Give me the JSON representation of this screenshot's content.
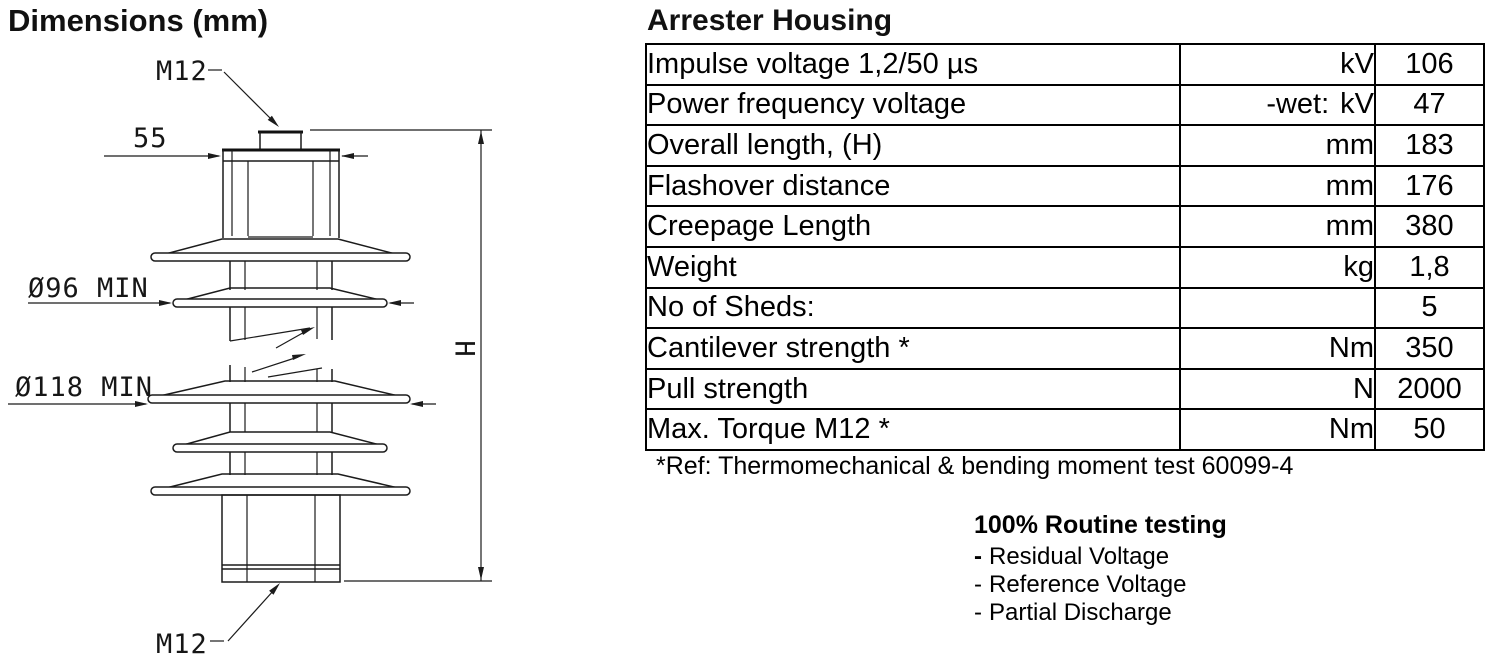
{
  "left_panel": {
    "title": "Dimensions (mm)",
    "drawing": {
      "labels": {
        "top_stud": "M12",
        "top_width": "55",
        "shed_small_diameter": "Ø96 MIN",
        "shed_large_diameter": "Ø118 MIN",
        "overall_height": "H",
        "bottom_stud": "M12"
      }
    }
  },
  "right_panel": {
    "title": "Arrester Housing",
    "table": {
      "rows": [
        {
          "label": "Impulse voltage 1,2/50 µs",
          "unit_prefix": "",
          "unit": "kV",
          "value": "106"
        },
        {
          "label": "Power frequency voltage",
          "unit_prefix": "-wet:",
          "unit": "kV",
          "value": "47"
        },
        {
          "label": "Overall length, (H)",
          "unit_prefix": "",
          "unit": "mm",
          "value": "183"
        },
        {
          "label": "Flashover distance",
          "unit_prefix": "",
          "unit": "mm",
          "value": "176"
        },
        {
          "label": "Creepage Length",
          "unit_prefix": "",
          "unit": "mm",
          "value": "380"
        },
        {
          "label": "Weight",
          "unit_prefix": "",
          "unit": "kg",
          "value": "1,8"
        },
        {
          "label": "No of Sheds:",
          "unit_prefix": "",
          "unit": "",
          "value": "5"
        },
        {
          "label": "Cantilever strength *",
          "unit_prefix": "",
          "unit": "Nm",
          "value": "350"
        },
        {
          "label": "Pull strength",
          "unit_prefix": "",
          "unit": "N",
          "value": "2000"
        },
        {
          "label": "Max. Torque M12 *",
          "unit_prefix": "",
          "unit": "Nm",
          "value": "50"
        }
      ],
      "footnote": "*Ref: Thermomechanical & bending moment test 60099-4"
    },
    "routine_testing": {
      "heading": "100% Routine testing",
      "items": [
        {
          "dash": "-",
          "text": "Residual Voltage"
        },
        {
          "dash": "-",
          "text": "Reference Voltage"
        },
        {
          "dash": "-",
          "text": "Partial Discharge"
        }
      ]
    }
  }
}
